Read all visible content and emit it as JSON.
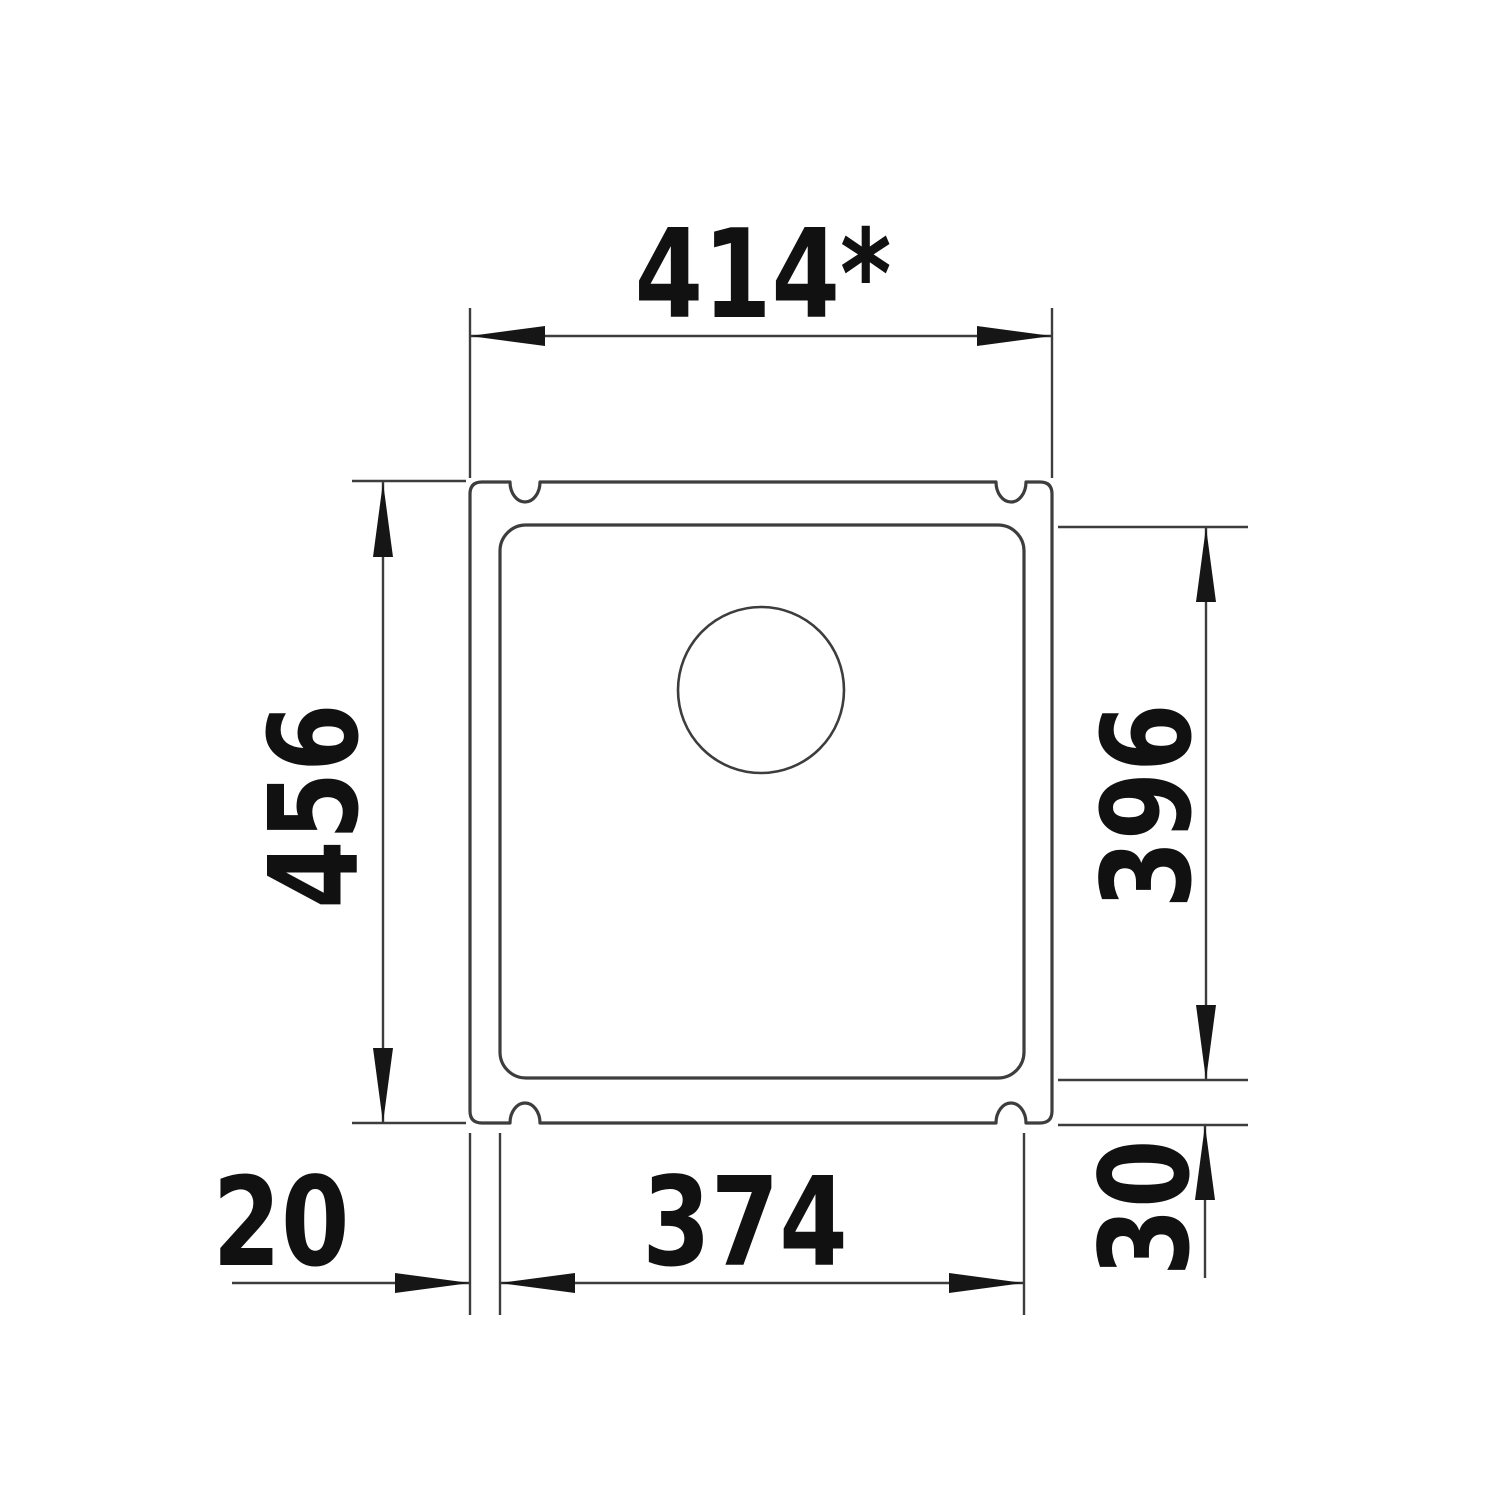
{
  "drawing": {
    "background_color": "#ffffff",
    "line_color": "#3d3d3d",
    "text_color": "#111111",
    "dimensions": {
      "top_width": "414*",
      "left_height": "456",
      "right_inner_height": "396",
      "bottom_inner_width": "374",
      "left_rim_width": "20",
      "bottom_right_rim_height": "30"
    }
  }
}
